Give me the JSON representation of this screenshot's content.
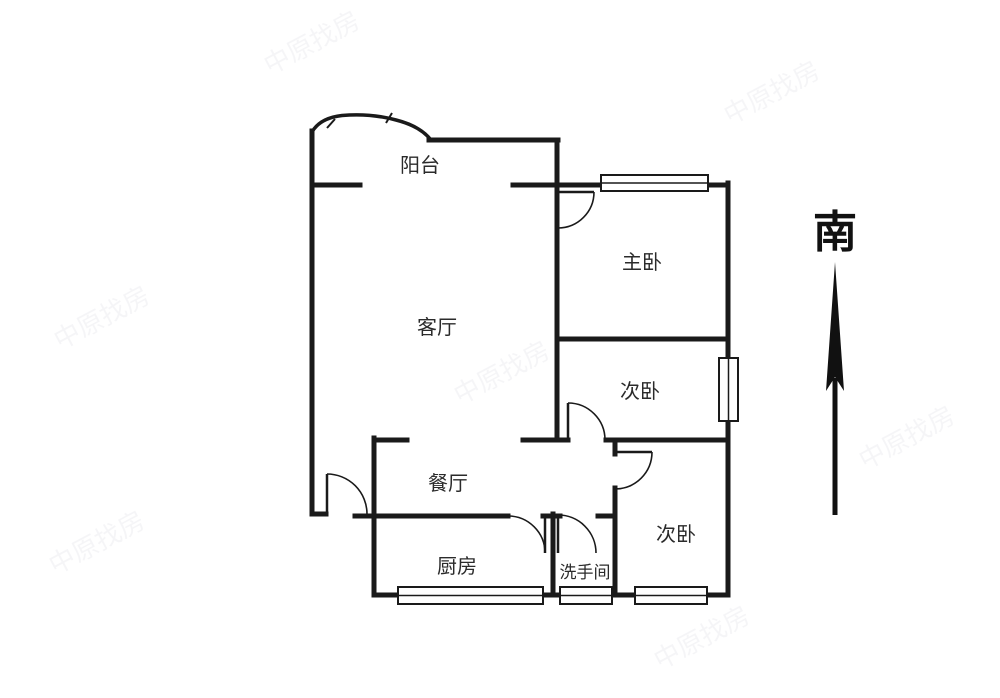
{
  "rooms": [
    {
      "id": "balcony",
      "label": "阳台"
    },
    {
      "id": "living-room",
      "label": "客厅"
    },
    {
      "id": "master-bedroom",
      "label": "主卧"
    },
    {
      "id": "second-bedroom-middle",
      "label": "次卧"
    },
    {
      "id": "dining-room",
      "label": "餐厅"
    },
    {
      "id": "kitchen",
      "label": "厨房"
    },
    {
      "id": "bathroom",
      "label": "洗手间"
    },
    {
      "id": "second-bedroom-bottom",
      "label": "次卧"
    }
  ],
  "compass": {
    "label": "南",
    "direction": "south-up"
  },
  "watermark": {
    "text": "中原找房"
  },
  "colors": {
    "wall": "#1a1a1a",
    "text": "#2b2b2b",
    "background": "#ffffff"
  }
}
